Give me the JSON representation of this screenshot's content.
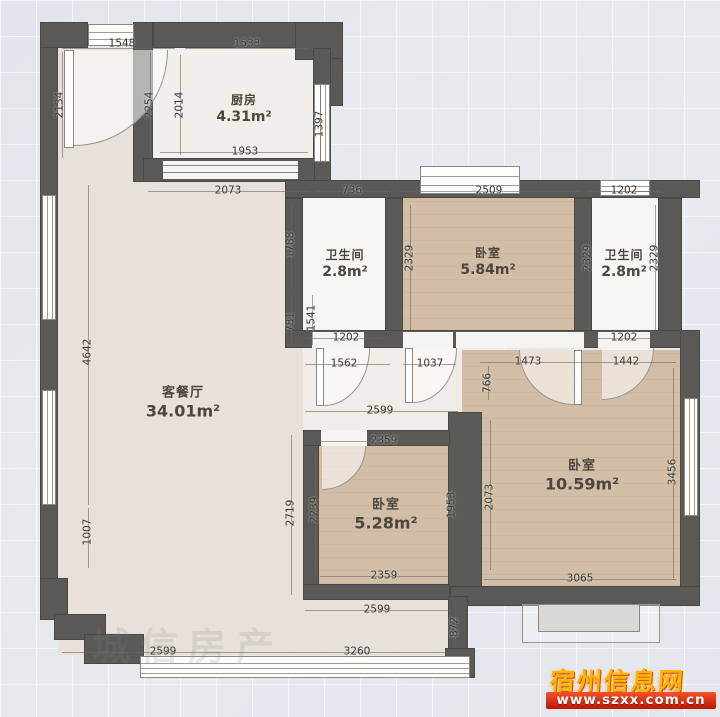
{
  "plan_title": "residential-floor-plan",
  "rooms": [
    {
      "name": "厨房",
      "area": "4.31m²"
    },
    {
      "name": "卫生间",
      "area": "2.8m²"
    },
    {
      "name": "卧室",
      "area": "5.84m²"
    },
    {
      "name": "卫生间",
      "area": "2.8m²"
    },
    {
      "name": "客餐厅",
      "area": "34.01m²"
    },
    {
      "name": "卧室",
      "area": "5.28m²"
    },
    {
      "name": "卧室",
      "area": "10.59m²"
    }
  ],
  "dims": [
    "1548",
    "1533",
    "2134",
    "2254",
    "2014",
    "1397",
    "1953",
    "2073",
    "736",
    "2509",
    "1202",
    "1788",
    "2329",
    "2329",
    "2329",
    "781",
    "1541",
    "1202",
    "1202",
    "4642",
    "1007",
    "1562",
    "1037",
    "1473",
    "1442",
    "766",
    "2599",
    "2359",
    "2239",
    "1953",
    "2719",
    "2073",
    "3456",
    "2359",
    "3065",
    "2599",
    "872",
    "2599",
    "3260"
  ],
  "watermarks": {
    "agency": "城信房产",
    "site_name": "宿州信息网",
    "site_url": "www.szxx.com.cn"
  },
  "colors": {
    "wall": "#5b5955",
    "living_floor": "#e8e0da",
    "bedroom_floor": "#d2bea6",
    "accent_red": "#c9200a",
    "accent_yellow": "#ffb400"
  }
}
